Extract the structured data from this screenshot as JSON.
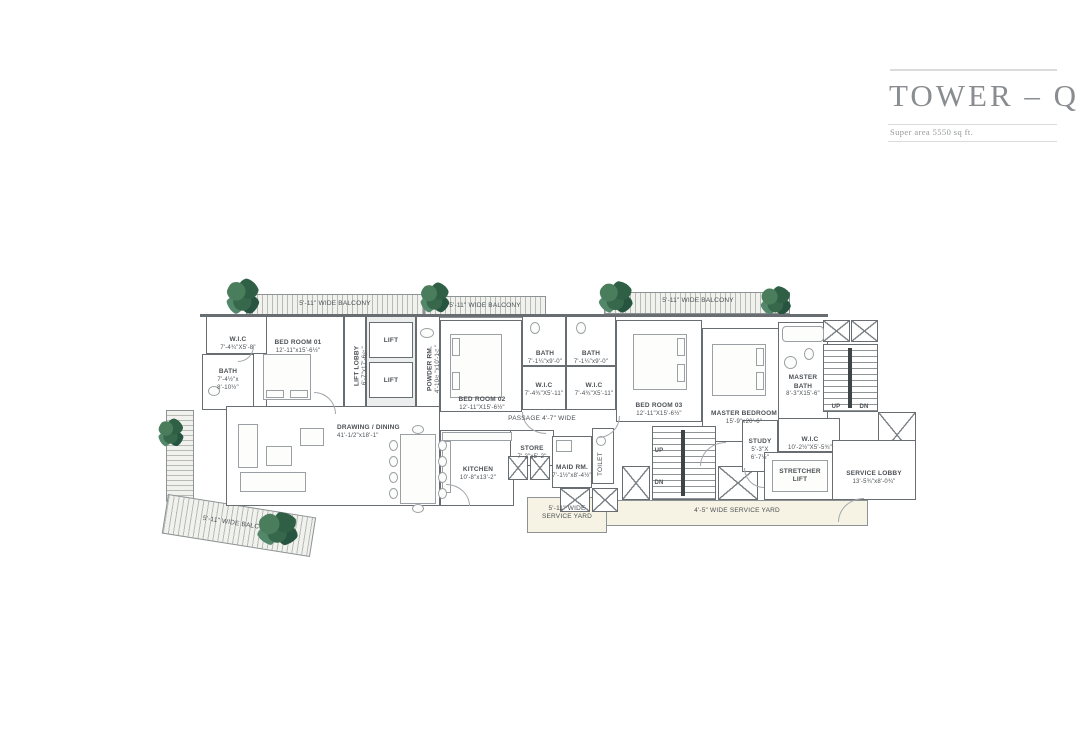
{
  "title_block": {
    "title": "TOWER – Q",
    "subtitle": "Super area 5550 sq ft."
  },
  "colors": {
    "wall": "#686d71",
    "plan_text": "#4b5054",
    "title_text": "#8a8d90",
    "balcony_hatch": "#b6bbb6",
    "service_yard_fill": "#f7f3e4",
    "plant_green": "#2f5f45"
  },
  "labels": {
    "balcony_top_left": "5'-11\" WIDE BALCONY",
    "balcony_top_mid": "5'-11\" WIDE BALCONY",
    "balcony_top_right": "5'-11\" WIDE BALCONY",
    "balcony_bottom_left": "5'-11\" WIDE BALCONY",
    "service_yard_left": "5'-11\" WIDE\nSERVICE YARD",
    "service_yard_right": "4'-5\" WIDE SERVICE YARD",
    "passage": "PASSAGE 4'-7\" WIDE",
    "up": "UP",
    "dn": "DN"
  },
  "rooms": {
    "wic_bed1": {
      "name": "W.I.C",
      "dims": "7'-4¾\"X5'-8\""
    },
    "bath_bed1": {
      "name": "BATH",
      "dims": "7'-4½\"x\n8'-10½\""
    },
    "bed_room_01": {
      "name": "BED ROOM 01",
      "dims": "12'-11\"x15'-6½\""
    },
    "lift_lobby": {
      "name": "LIFT LOBBY",
      "dims": "6'-7\"x17'-6½\""
    },
    "lift_1": {
      "name": "LIFT"
    },
    "lift_2": {
      "name": "LIFT"
    },
    "powder_rm": {
      "name": "POWDER RM.",
      "dims": "4'-10½\"x10'-1¼\""
    },
    "bed_room_02": {
      "name": "BED ROOM 02",
      "dims": "12'-11\"X15'-6½\""
    },
    "bath_bed2": {
      "name": "BATH",
      "dims": "7'-1¼\"x9'-0\""
    },
    "wic_bed2": {
      "name": "W.I.C",
      "dims": "7'-4¾\"X5'-11\""
    },
    "bath_bed3": {
      "name": "BATH",
      "dims": "7'-1¼\"x9'-0\""
    },
    "wic_bed3": {
      "name": "W.I.C",
      "dims": "7'-4¾\"X5'-11\""
    },
    "bed_room_03": {
      "name": "BED ROOM 03",
      "dims": "12'-11\"X15'-6½\""
    },
    "master_bedroom": {
      "name": "MASTER BEDROOM",
      "dims": "15'-9\"x20'-6\""
    },
    "master_bath": {
      "name": "MASTER\nBATH",
      "dims": "8'-3\"X15'-6\""
    },
    "drawing_dining": {
      "name": "DRAWING / DINING",
      "dims": "41'-1/2\"x18'-1\""
    },
    "store": {
      "name": "STORE",
      "dims": "7'-2\"x5'-2\""
    },
    "kitchen": {
      "name": "KITCHEN",
      "dims": "10'-8\"x13'-2\""
    },
    "maid_rm": {
      "name": "MAID RM.",
      "dims": "7'-1½\"x8'-4½\""
    },
    "toilet": {
      "name": "TOILET"
    },
    "study": {
      "name": "STUDY",
      "dims": "5'-3\"X\n6'-7½\""
    },
    "wic_master": {
      "name": "W.I.C",
      "dims": "10'-2½\"X5'-5¾\""
    },
    "stretcher_lift": {
      "name": "STRETCHER\nLIFT"
    },
    "service_lobby": {
      "name": "SERVICE LOBBY",
      "dims": "13'-5¾\"x8'-0¾\""
    }
  }
}
